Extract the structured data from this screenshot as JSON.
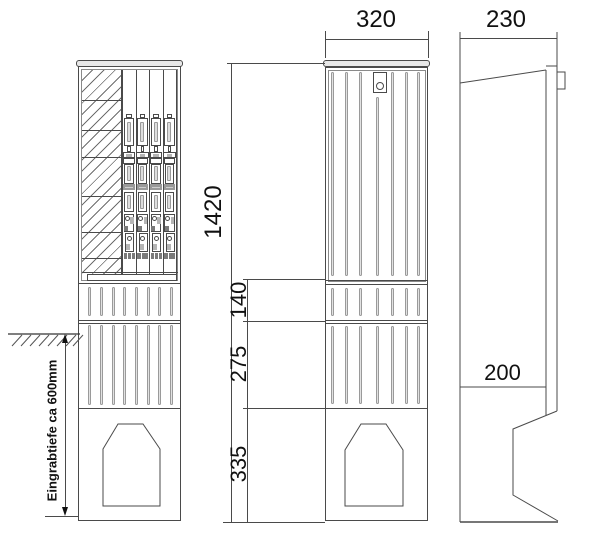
{
  "title": "Cable distribution cabinet dimensioned drawing",
  "labels": {
    "width_front": "320",
    "depth_top": "230",
    "height_total": "1420",
    "segment_upper": "140",
    "segment_middle": "275",
    "segment_lower": "335",
    "depth_bottom": "200",
    "burial_depth_note": "Eingrabtiefe ca 600mm"
  },
  "colors": {
    "line": "#4a4a4a",
    "text": "#111111",
    "rib_fill": "#e2e2e2",
    "label_strip": "#9a9a9a",
    "background": "#ffffff"
  }
}
